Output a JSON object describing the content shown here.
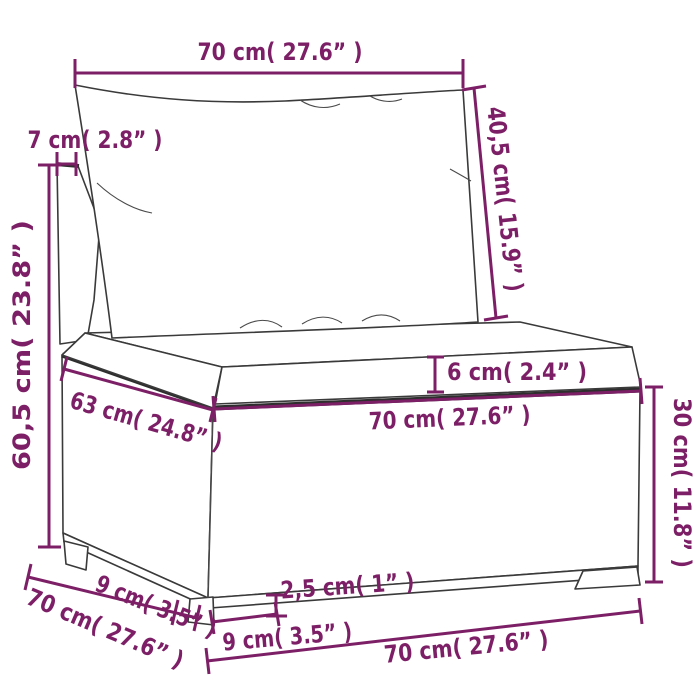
{
  "figure": {
    "kind": "product dimension line drawing",
    "subject": "poly rattan garden sofa middle section with back pillow and seat cushion"
  },
  "colors": {
    "dimension_accent": "#7D1F66",
    "line_art": "#3A3A3A",
    "background": "#FFFFFF"
  },
  "dims": {
    "top_width": {
      "label": "70 cm( 27.6” )"
    },
    "backrest_depth": {
      "label": "7 cm( 2.8” )"
    },
    "total_height": {
      "label": "60,5 cm( 23.8” )"
    },
    "backrest_height": {
      "label": "40,5 cm( 15.9” )"
    },
    "cushion_thickness": {
      "label": "6 cm( 2.4” )"
    },
    "seat_front_width": {
      "label": "70 cm( 27.6” )"
    },
    "seat_depth": {
      "label": "63 cm( 24.8” )"
    },
    "foot_depth_left": {
      "label": "9 cm( 3.5” )"
    },
    "base_depth": {
      "label": "70 cm( 27.6” )"
    },
    "front_foot_width": {
      "label": "9 cm( 3.5” )"
    },
    "foot_height": {
      "label": "2,5 cm( 1” )"
    },
    "base_width": {
      "label": "70 cm( 27.6” )"
    },
    "base_height": {
      "label": "30 cm( 11.8” )"
    }
  }
}
